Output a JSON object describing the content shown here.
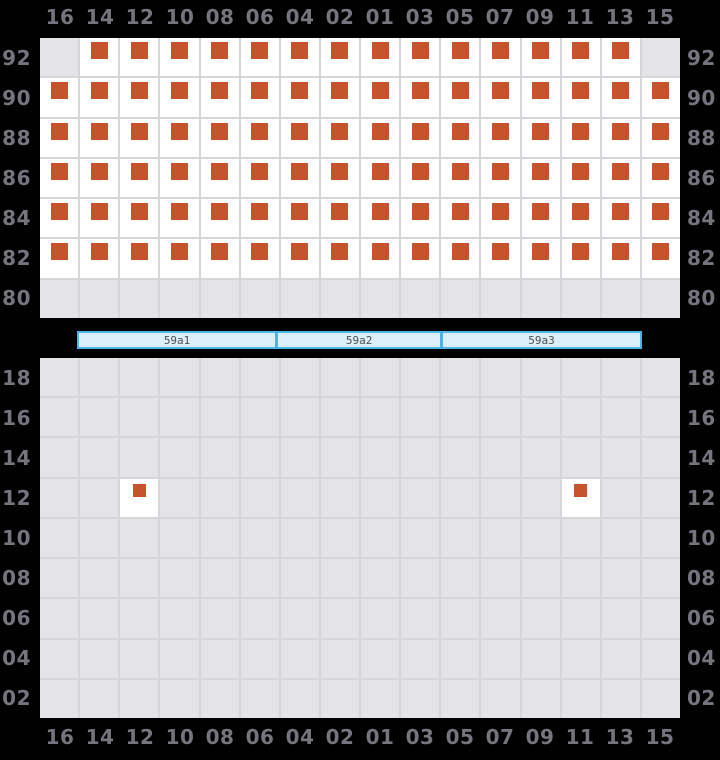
{
  "columns": [
    "16",
    "14",
    "12",
    "10",
    "08",
    "06",
    "04",
    "02",
    "01",
    "03",
    "05",
    "07",
    "09",
    "11",
    "13",
    "15"
  ],
  "upper_deck": {
    "row_labels": [
      "92",
      "90",
      "88",
      "86",
      "84",
      "82",
      "80"
    ],
    "cell_rows": [
      "gssssssssssssssg",
      "ssssssssssssssss",
      "ssssssssssssssss",
      "ssssssssssssssss",
      "ssssssssssssssss",
      "ssssssssssssssss",
      "gggggggggggggggg"
    ]
  },
  "section_bar": {
    "segments": [
      {
        "label": "59a1",
        "width": 198
      },
      {
        "label": "59a2",
        "width": 158
      },
      {
        "label": "59a3",
        "width": 199
      }
    ]
  },
  "lower_deck": {
    "row_labels": [
      "18",
      "16",
      "14",
      "12",
      "10",
      "08",
      "06",
      "04",
      "02"
    ],
    "cell_rows": [
      "gggggggggggggggg",
      "gggggggggggggggg",
      "gggggggggggggggg",
      "ggsggggggggggsgg",
      "gggggggggggggggg",
      "gggggggggggggggg",
      "gggggggggggggggg",
      "gggggggggggggggg",
      "gggggggggggggggg"
    ]
  },
  "cell_codes": {
    "g": "unavailable",
    "s": "occupied"
  },
  "colors": {
    "background": "#000000",
    "available_cell": "#ffffff",
    "unavailable_cell": "#e4e3e6",
    "grid_line": "#d6d5d9",
    "occupied_marker": "#c5542c",
    "axis_label": "#75757f",
    "section_bar_fill": "#dbeefa",
    "section_bar_border": "#49b5e7",
    "section_bar_text": "#4f4f4f"
  }
}
